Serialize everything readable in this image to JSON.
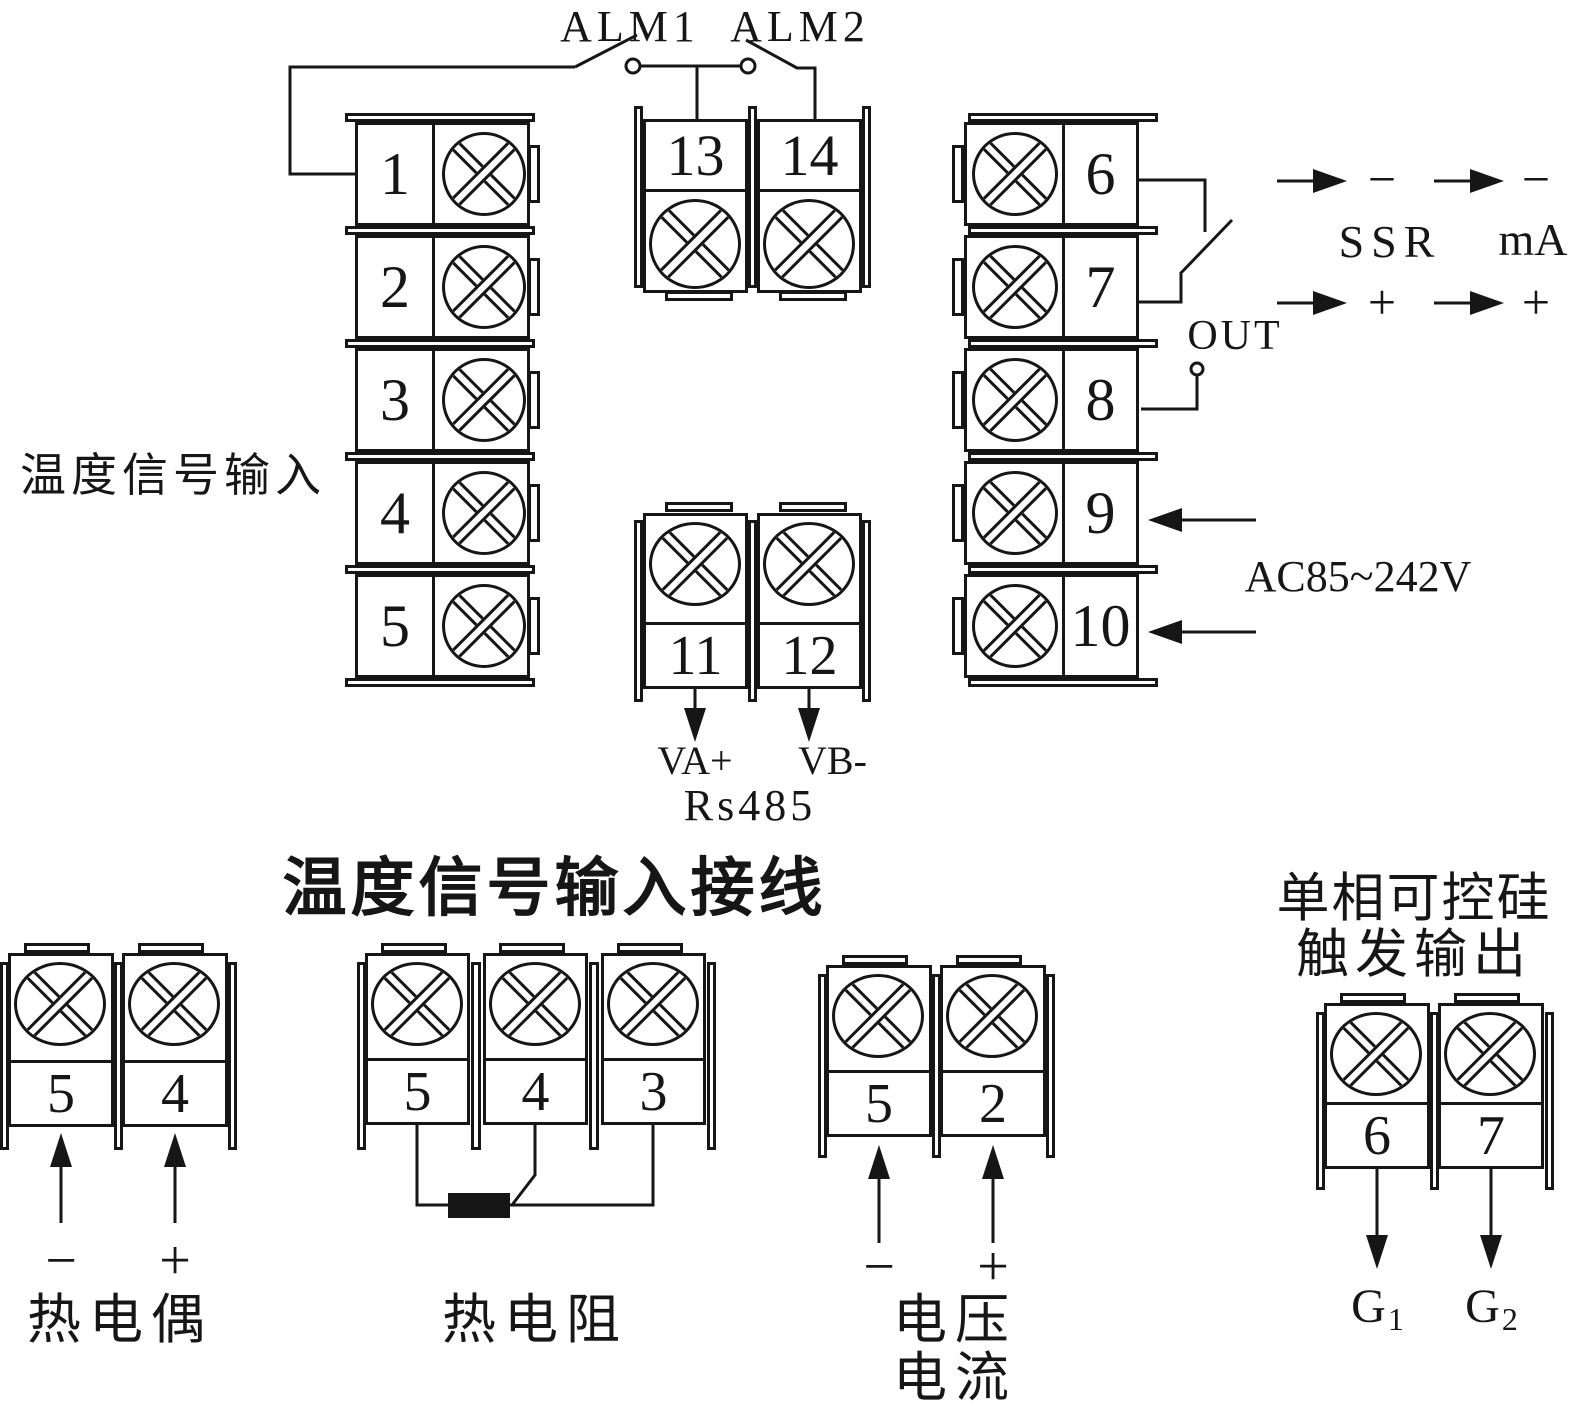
{
  "diagram": {
    "alm1": "ALM1",
    "alm2": "ALM2",
    "temp_input_label": "温度信号输入",
    "left_terminals": [
      "1",
      "2",
      "3",
      "4",
      "5"
    ],
    "alarm_terminals": [
      "13",
      "14"
    ],
    "comm": {
      "t11": "11",
      "t12": "12",
      "va": "VA+",
      "vb": "VB-",
      "rs485": "Rs485"
    },
    "right_terminals": [
      "6",
      "7",
      "8",
      "9",
      "10"
    ],
    "out_label": "OUT",
    "ssr_label": "SSR",
    "ma_label": "mA",
    "minus": "−",
    "plus": "+",
    "ac_label": "AC85~242V",
    "bottom_title": "温度信号输入接线",
    "thermocouple": {
      "t5": "5",
      "t4": "4",
      "label": "热电偶"
    },
    "rtd": {
      "t5": "5",
      "t4": "4",
      "t3": "3",
      "label": "热电阻"
    },
    "vi": {
      "t5": "5",
      "t2": "2",
      "label1": "电压",
      "label2": "电流"
    },
    "scr": {
      "title1": "单相可控硅",
      "title2": "触发输出",
      "t6": "6",
      "t7": "7",
      "g": "G",
      "sub1": "1",
      "sub2": "2"
    }
  }
}
